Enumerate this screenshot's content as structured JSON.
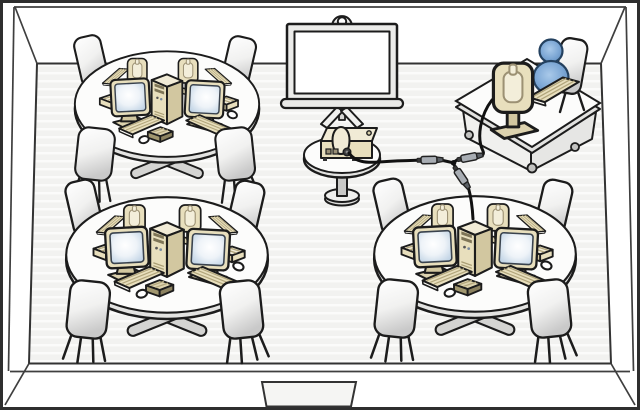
{
  "scene": {
    "label": "Classroom computer lab floor plan diagram",
    "room": {
      "walls": 4,
      "doors": 1,
      "door_position": "bottom-center",
      "floor_style": "striped"
    },
    "student_tables": {
      "count": 3,
      "positions": [
        "top-left",
        "bottom-left",
        "bottom-right"
      ],
      "per_table": {
        "computers": 4,
        "monitors_facing_viewer": 2,
        "monitors_facing_away": 2,
        "keyboards": 4,
        "tower_pc": 1,
        "hub_box": 1,
        "speaker_bars": 2,
        "mice": 2,
        "chairs": 4
      }
    },
    "teacher_station": {
      "desk": 1,
      "monitor": 1,
      "keyboard": 1,
      "chair": 1,
      "person": 1,
      "caster_wheels": 3
    },
    "projection": {
      "screen": 1,
      "screen_type": "tripod",
      "projector": 1,
      "projector_stand": 1
    },
    "cabling": {
      "cables": 3,
      "connector_plugs": 3,
      "junctions": 1,
      "links": [
        "projector to junction",
        "teacher desk computer to junction",
        "junction to bottom-right table tower"
      ]
    }
  },
  "palette": {
    "outline": "#1c1c1c",
    "wall-line": "#3f3f3f",
    "floor": "#f2f2f0",
    "floor-stripe": "#fbfbfa",
    "wall": "#ffffff",
    "equipment-beige": "#e8dfbd",
    "equipment-beige-light": "#f1ebd6",
    "equipment-beige-mid": "#ddd3af",
    "equipment-beige-dark": "#d2c7a0",
    "keyboard-hatch": "#b2a67c",
    "drive-bay": "#7e7557",
    "screen-blue": "#b3cadf",
    "person-blue": "#5584b8",
    "person-blue-light": "#a9c9e9",
    "person-outline": "#24415f",
    "furniture-white": "#fcfcfb",
    "furniture-gray": "#e3e3e1",
    "metal-gray": "#c9c9c7",
    "cable": "#111111"
  }
}
